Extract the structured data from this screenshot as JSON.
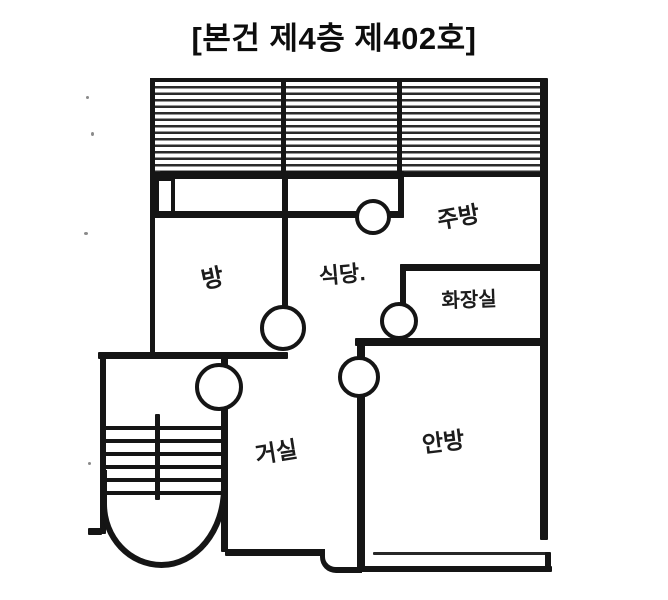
{
  "title": "[본건 제4층 제402호]",
  "plan": {
    "labels": {
      "kitchen": "주방",
      "dining": "식당.",
      "small_room": "방",
      "bathroom": "화장실",
      "living_room": "거실",
      "master_bedroom": "안방"
    },
    "ink_color": "#151515",
    "paper_color": "#ffffff"
  }
}
